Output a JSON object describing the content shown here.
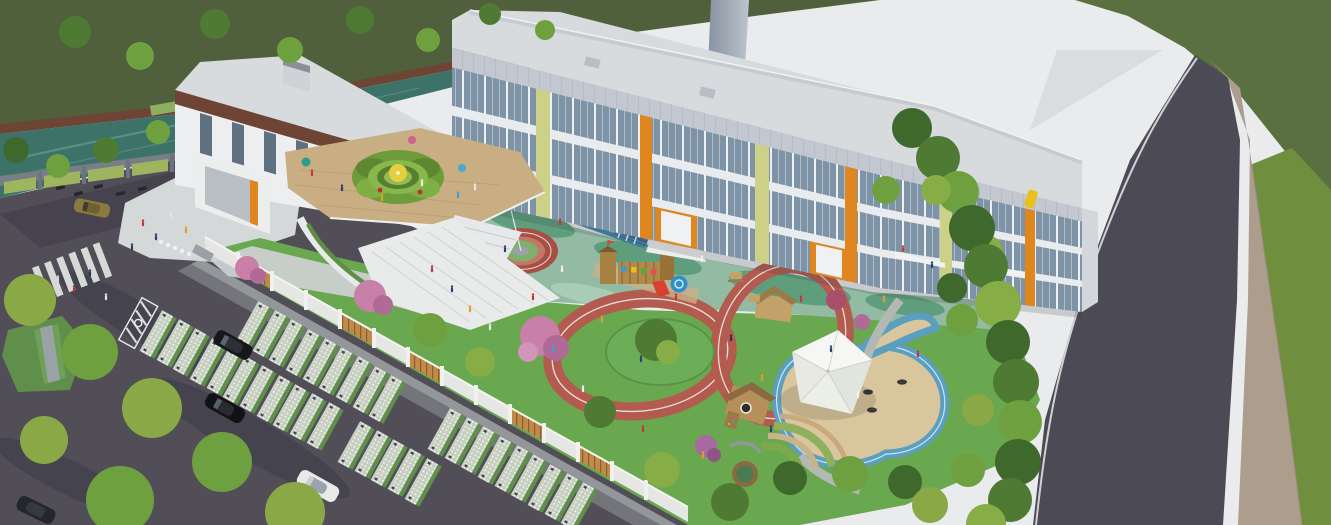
{
  "image_type": "aerial-architectural-rendering",
  "subject": "Bird's-eye 3D rendering of a kindergarten campus: L-shaped 3-storey white school building with glass curtain walls and orange/yellow-green accents, rooftop play terrace with circular green maze, central courtyard with blue sprint track, flag podium, wooden play castle and looping red running tracks, sand pit with white tensile canopy, perimeter fence, tree belts, parking lot with grass pavers and a curving perimeter road",
  "visible_text": [],
  "palette": {
    "bg-white": "#e9ebec",
    "lawn-dark": "#51603c",
    "lawn-right": "#5b7040",
    "lawn-bright": "#6f8f3e",
    "river": "#3c7268",
    "river-light": "#5f978a",
    "embankment": "#6e4434",
    "asphalt": "#514e58",
    "asphalt-shadow": "#393742",
    "road": "#4c4a54",
    "road-line": "#cfd2d4",
    "sidewalk": "#ad9d8d",
    "paver-base": "#c6cfc0",
    "stall-grass": "#5f8f4a",
    "apron": "#9aa0a2",
    "plaza": "#d5d8d9",
    "fence-gray": "#787e86",
    "fence-green": "#9fb45e",
    "wall-white": "#e6e7e5",
    "wood-slat": "#c08a4a",
    "wood-dark": "#8a5f2e",
    "bldg-white": "#eceef0",
    "bldg-spandrel": "#e9ecee",
    "stone-band": "#c3c8d0",
    "roof": "#d8dbde",
    "roof-edge": "#c6cbd1",
    "glass": "#7e93a6",
    "accent-orange": "#e0861f",
    "accent-yellowgreen": "#ccd187",
    "brown-band": "#6e4434",
    "tower-dark": "#8793a2",
    "tower-light": "#bcc3cc",
    "court-sage": "#93bba4",
    "court-dark": "#5f9e7c",
    "track-blue": "#3f85ad",
    "track-red": "#b25b4e",
    "flag-red": "#d42020",
    "play-green": "#6aa84f",
    "island-green": "#6cae57",
    "sand": "#d9c69c",
    "water-play": "#5b9fc0",
    "canopy": "#f2f3f0",
    "deck-tan": "#c9ae83",
    "maze-green": "#6f9c3a",
    "maze-center": "#e6cf3e",
    "tree1": "#4f7a33",
    "tree2": "#6fa03f",
    "tree3": "#86ad46",
    "tree4": "#3f682c",
    "tree-yellow": "#8aa845",
    "blossom-pink": "#c87fa8",
    "wood-play": "#b08a4a",
    "slide-red": "#d84030",
    "slide-blue": "#2f8fc8",
    "pavilion-yellow": "#e8c728"
  },
  "scene": {
    "building": {
      "storeys": 3,
      "features": [
        "glass curtain wall",
        "stone parapet band",
        "orange entrance portals",
        "yellow-green pilasters",
        "brown fascia band on west wing",
        "rooftop play terrace with circular hedge maze and yellow canopy",
        "grand stair with green slide lawn",
        "white grandstand steps",
        "gray service tower behind roof"
      ]
    },
    "courtyard": [
      "teal-sage play surface",
      "straight blue running lanes",
      "flagpole with red flag on circular red podium",
      "wooden play castle with red slide and blue tube",
      "two looping red rubber tracks",
      "tree island",
      "mini track loop with yellow pavilion"
    ],
    "east-playground": [
      "sand pit ringed by blue water channel",
      "white four-point tensile canopy",
      "tire rings in sand",
      "timber play cabins",
      "picnic tables",
      "terraced planting arcs",
      "round timber planter"
    ],
    "site": [
      "teal canal with brown embankment at north-west",
      "gray fence with green louver panels on street side",
      "white campus wall with timber slat panels",
      "asphalt forecourt with zebra crossing and green median mound",
      "parking stalls in grass pavers",
      "tree belts",
      "dark curving perimeter road with beige stone sidewalk"
    ],
    "vehicles": [
      "black suv",
      "black sedan",
      "white sedan",
      "gold hatchback",
      "dark car at corner",
      "scooters along fence"
    ],
    "people": "small figures walking in forecourt, courtyard, stairs and rooftop terrace"
  }
}
